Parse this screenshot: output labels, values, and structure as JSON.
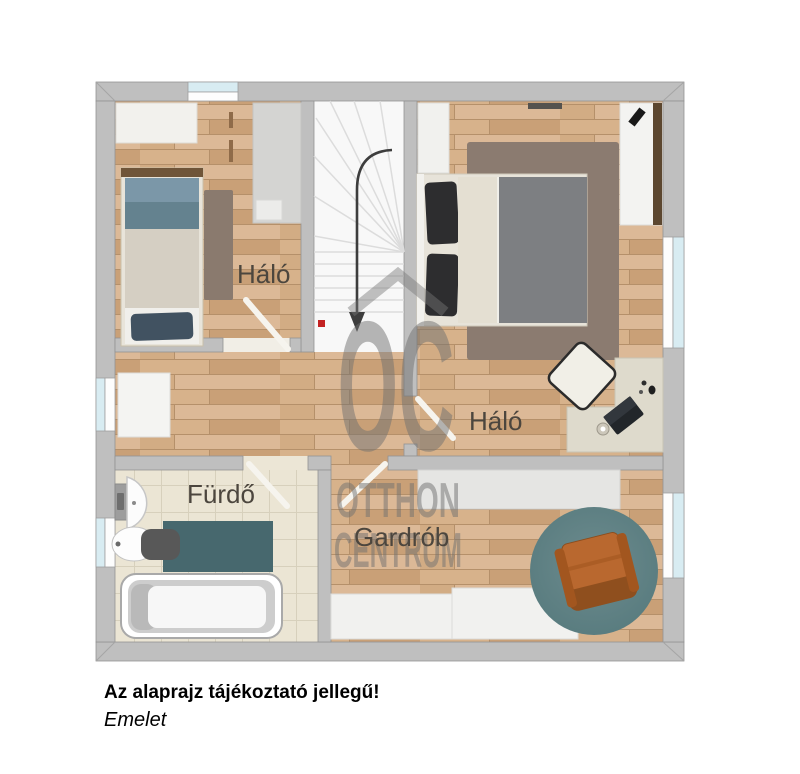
{
  "page": {
    "background": "#ffffff"
  },
  "watermark": {
    "logo": "OC",
    "brand_line1": "OTTHON",
    "brand_line2": "CENTRUM"
  },
  "rooms": {
    "bedroom_small": {
      "label": "Háló"
    },
    "bedroom_master": {
      "label": "Háló"
    },
    "bathroom": {
      "label": "Fürdő"
    },
    "wardrobe_room": {
      "label": "Gardrób"
    }
  },
  "caption": {
    "disclaimer": "Az alaprajz tájékoztató jellegű!",
    "floor_name": "Emelet"
  },
  "colors": {
    "wall": "#bfbfbf",
    "wood_floor": "#cfa87f",
    "tile_floor": "#ebe5d4",
    "stairs": "#f8f8f8",
    "window_glass": "#d8ecf2",
    "round_rug_teal": "#5d7f82",
    "bath_mat_teal": "#47686e",
    "armchair_orange": "#b5652f",
    "bed_blanket_blue": "#6e8b9d",
    "bed_blanket_grey": "#7d7f82",
    "watermark_grey": "#6f6f6f",
    "room_label_text": "#4c463e",
    "stair_marker_red": "#c32222"
  }
}
